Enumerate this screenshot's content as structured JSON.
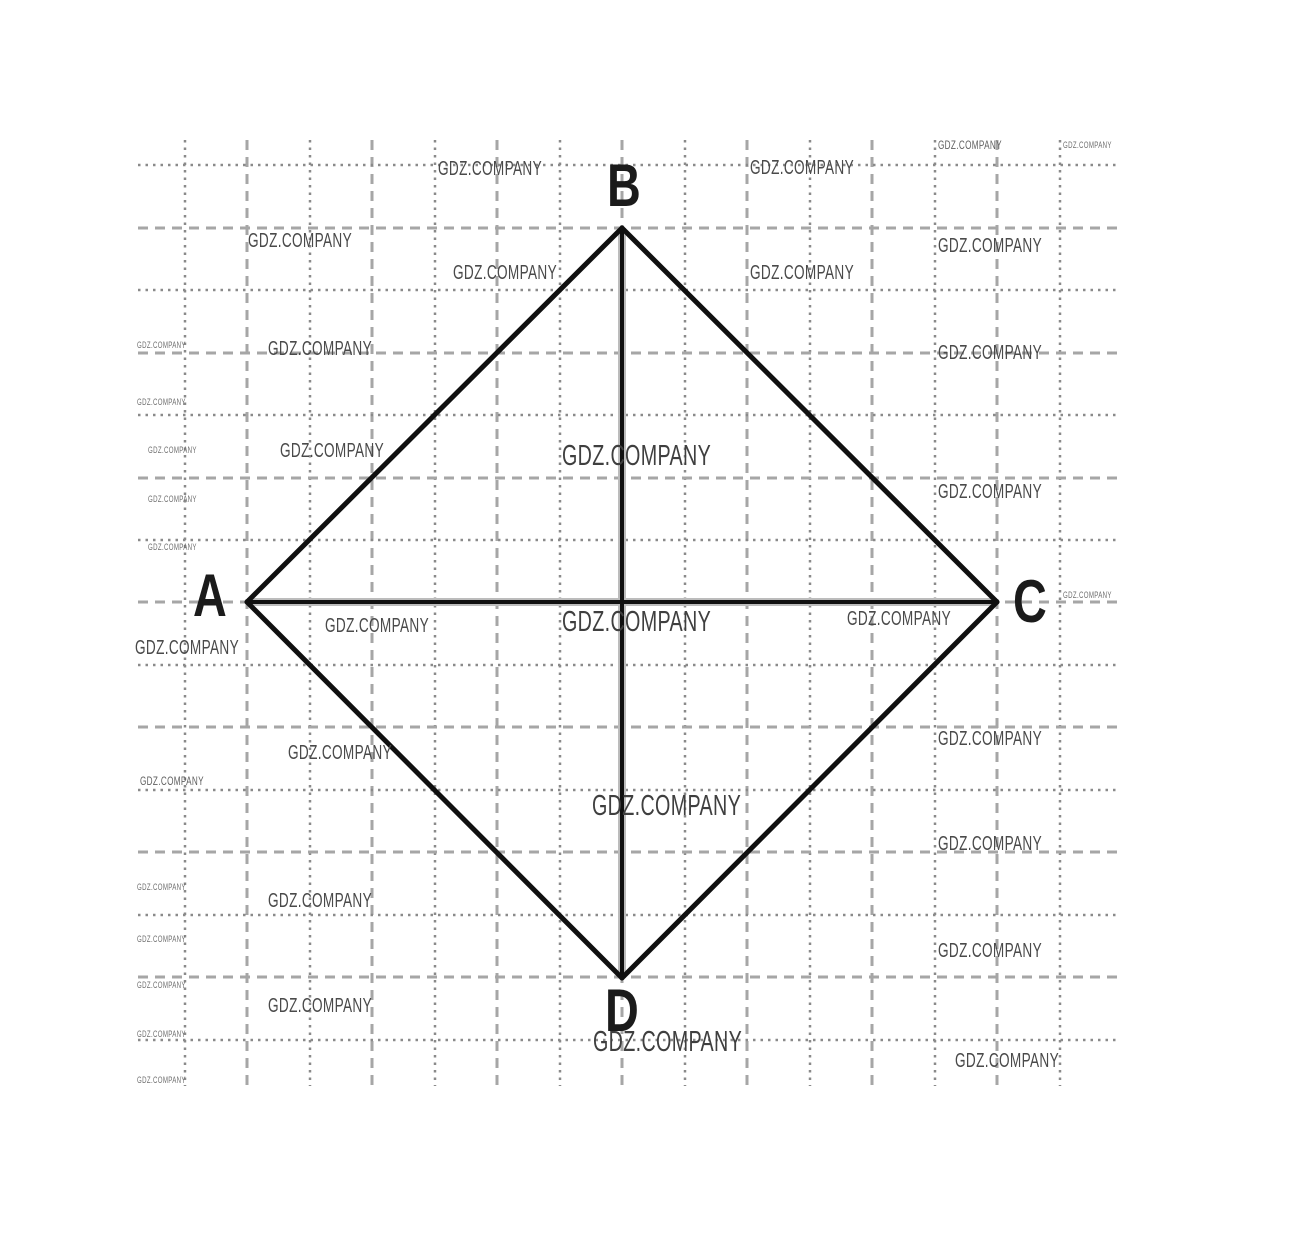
{
  "diagram": {
    "canvas": {
      "width": 1290,
      "height": 1252,
      "background": "#ffffff"
    },
    "grid": {
      "x_start": 138,
      "x_end": 1118,
      "y_start": 140,
      "y_end": 1086,
      "styles": {
        "dotted": {
          "color": "#8a8a8a",
          "width": 2.5,
          "dash": "2.5 5"
        },
        "dashed": {
          "color": "#a6a6a6",
          "width": 3,
          "dash": "10 7"
        }
      },
      "vertical_lines": [
        {
          "x": 185,
          "style": "dotted"
        },
        {
          "x": 247,
          "style": "dashed"
        },
        {
          "x": 310,
          "style": "dotted"
        },
        {
          "x": 372,
          "style": "dashed"
        },
        {
          "x": 435,
          "style": "dotted"
        },
        {
          "x": 497,
          "style": "dashed"
        },
        {
          "x": 560,
          "style": "dotted"
        },
        {
          "x": 622,
          "style": "dashed"
        },
        {
          "x": 685,
          "style": "dotted"
        },
        {
          "x": 747,
          "style": "dashed"
        },
        {
          "x": 810,
          "style": "dotted"
        },
        {
          "x": 872,
          "style": "dashed"
        },
        {
          "x": 935,
          "style": "dotted"
        },
        {
          "x": 997,
          "style": "dashed"
        },
        {
          "x": 1060,
          "style": "dotted"
        }
      ],
      "horizontal_lines": [
        {
          "y": 165,
          "style": "dotted"
        },
        {
          "y": 228,
          "style": "dashed"
        },
        {
          "y": 290,
          "style": "dotted"
        },
        {
          "y": 353,
          "style": "dashed"
        },
        {
          "y": 415,
          "style": "dotted"
        },
        {
          "y": 478,
          "style": "dashed"
        },
        {
          "y": 540,
          "style": "dotted"
        },
        {
          "y": 602,
          "style": "dashed"
        },
        {
          "y": 665,
          "style": "dotted"
        },
        {
          "y": 727,
          "style": "dashed"
        },
        {
          "y": 790,
          "style": "dotted"
        },
        {
          "y": 852,
          "style": "dashed"
        },
        {
          "y": 915,
          "style": "dotted"
        },
        {
          "y": 977,
          "style": "dashed"
        },
        {
          "y": 1040,
          "style": "dotted"
        }
      ]
    },
    "shape": {
      "name": "quadrilateral ABCD with diagonals",
      "edge_color": "#101010",
      "edge_width": 5,
      "diagonal_color": "#101010",
      "diagonal_width": 4,
      "fringe_color": "#bcbcbc",
      "fringe_width": 8,
      "vertices": {
        "A": [
          247,
          602
        ],
        "B": [
          622,
          228
        ],
        "C": [
          997,
          602
        ],
        "D": [
          622,
          978
        ]
      },
      "edges": [
        [
          "A",
          "B"
        ],
        [
          "B",
          "C"
        ],
        [
          "C",
          "D"
        ],
        [
          "D",
          "A"
        ]
      ],
      "diagonals": [
        [
          "A",
          "C"
        ],
        [
          "B",
          "D"
        ]
      ]
    },
    "vertex_labels": [
      {
        "text": "A",
        "left": 193,
        "top": 566
      },
      {
        "text": "B",
        "left": 607,
        "top": 156
      },
      {
        "text": "C",
        "left": 1013,
        "top": 572
      },
      {
        "text": "D",
        "left": 605,
        "top": 981
      }
    ],
    "watermark_text": "GDZ.COMPANY",
    "watermarks": [
      {
        "left": 438,
        "top": 159,
        "size": "medium"
      },
      {
        "left": 750,
        "top": 158,
        "size": "medium"
      },
      {
        "left": 938,
        "top": 139,
        "size": "small"
      },
      {
        "left": 1063,
        "top": 141,
        "size": "tiny"
      },
      {
        "left": 248,
        "top": 231,
        "size": "medium"
      },
      {
        "left": 453,
        "top": 263,
        "size": "medium"
      },
      {
        "left": 750,
        "top": 263,
        "size": "medium"
      },
      {
        "left": 938,
        "top": 236,
        "size": "medium"
      },
      {
        "left": 137,
        "top": 341,
        "size": "tiny"
      },
      {
        "left": 268,
        "top": 339,
        "size": "medium"
      },
      {
        "left": 938,
        "top": 343,
        "size": "medium"
      },
      {
        "left": 137,
        "top": 398,
        "size": "tiny"
      },
      {
        "left": 148,
        "top": 446,
        "size": "tiny"
      },
      {
        "left": 280,
        "top": 441,
        "size": "medium"
      },
      {
        "left": 562,
        "top": 442,
        "size": "large"
      },
      {
        "left": 148,
        "top": 495,
        "size": "tiny"
      },
      {
        "left": 938,
        "top": 482,
        "size": "medium"
      },
      {
        "left": 148,
        "top": 543,
        "size": "tiny"
      },
      {
        "left": 325,
        "top": 616,
        "size": "medium"
      },
      {
        "left": 562,
        "top": 608,
        "size": "large"
      },
      {
        "left": 847,
        "top": 609,
        "size": "medium"
      },
      {
        "left": 1063,
        "top": 591,
        "size": "tiny"
      },
      {
        "left": 135,
        "top": 638,
        "size": "medium"
      },
      {
        "left": 288,
        "top": 743,
        "size": "medium"
      },
      {
        "left": 938,
        "top": 729,
        "size": "medium"
      },
      {
        "left": 140,
        "top": 775,
        "size": "small"
      },
      {
        "left": 592,
        "top": 792,
        "size": "large"
      },
      {
        "left": 938,
        "top": 834,
        "size": "medium"
      },
      {
        "left": 137,
        "top": 883,
        "size": "tiny"
      },
      {
        "left": 268,
        "top": 891,
        "size": "medium"
      },
      {
        "left": 137,
        "top": 935,
        "size": "tiny"
      },
      {
        "left": 938,
        "top": 941,
        "size": "medium"
      },
      {
        "left": 137,
        "top": 981,
        "size": "tiny"
      },
      {
        "left": 268,
        "top": 996,
        "size": "medium"
      },
      {
        "left": 593,
        "top": 1028,
        "size": "large"
      },
      {
        "left": 137,
        "top": 1030,
        "size": "tiny"
      },
      {
        "left": 955,
        "top": 1051,
        "size": "medium"
      },
      {
        "left": 137,
        "top": 1076,
        "size": "tiny"
      }
    ]
  }
}
